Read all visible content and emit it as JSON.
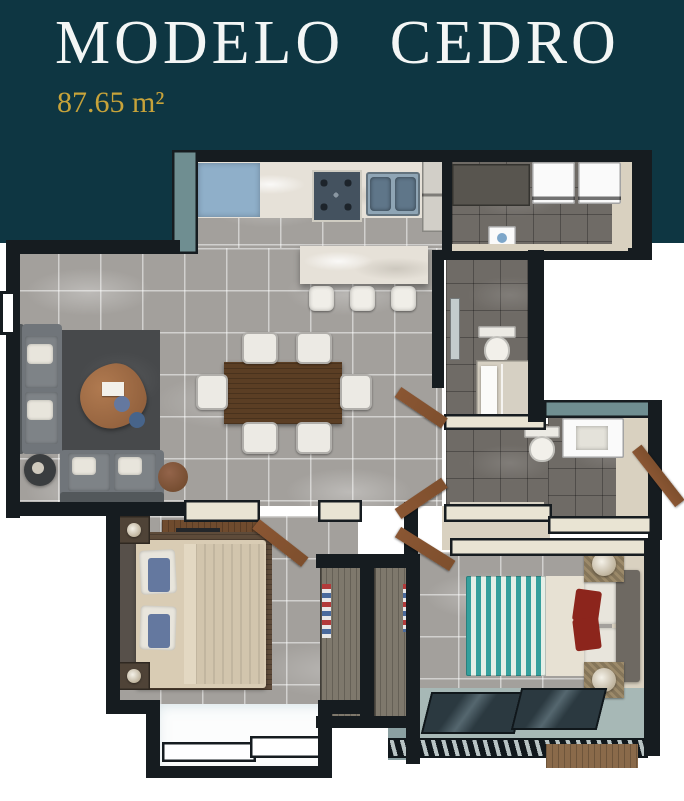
{
  "header": {
    "title": "MODELO CEDRO",
    "area_label": "87.65 m²"
  },
  "colors": {
    "page_bg": "#ffffff",
    "header_bg": "#0e3642",
    "title_text": "#f3f6f5",
    "accent_gold": "#c7a33a",
    "wall_dark": "#161c20",
    "wall_cream": "#e9e4d3",
    "wall_teal": "#6f8e91",
    "tile_light": "#a3a09c",
    "tile_dark": "#6f6b66",
    "marble": "#e6e1d8",
    "counter_blue": "#8fafc9",
    "appliance_steel": "#44525f",
    "wood_door": "#7e4f2d",
    "wood_table": "#5b3e24",
    "rug_dark": "#47494b",
    "sofa_gray": "#70757a",
    "bed_beige": "#d9ccb4",
    "rug_wood": "#5e4b3a",
    "chevron_teal": "#35a09d",
    "pillow_red": "#8c251c",
    "pillow_blue": "#64789f",
    "terrace_teal": "#a7b8b6",
    "closet_wood": "#7e786c",
    "basket_tan": "#9c8a6a"
  }
}
